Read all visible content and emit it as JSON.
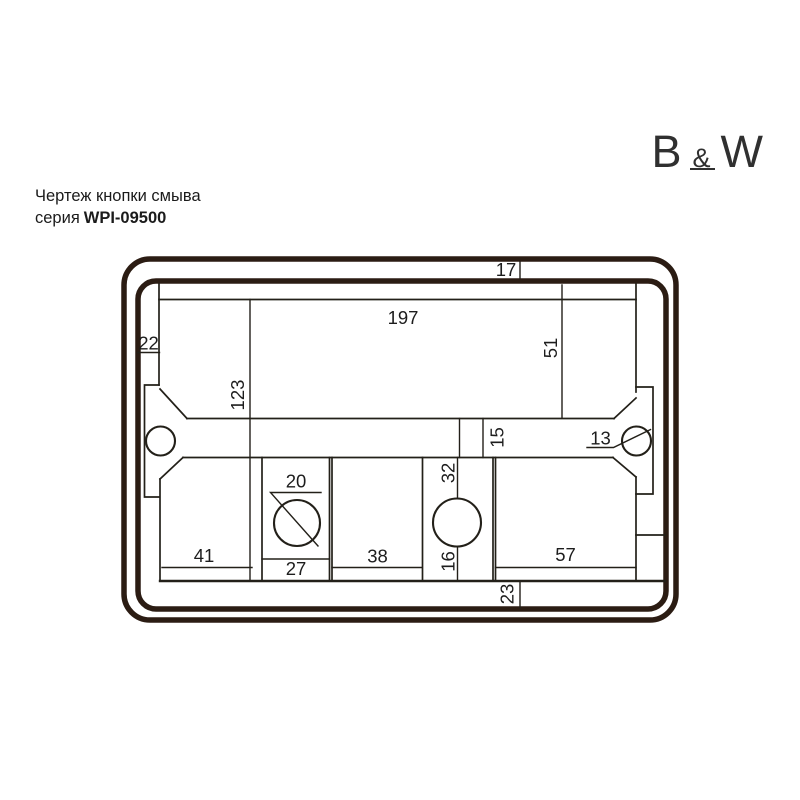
{
  "header": {
    "title": "Чертеж кнопки смыва",
    "series_label": "серия",
    "series_code": "WPI-09500"
  },
  "logo": {
    "left": "B",
    "amp": "&",
    "right": "W"
  },
  "drawing": {
    "colors": {
      "frame": "#2b1c13",
      "line": "#232019",
      "text": "#1d1d1d"
    },
    "dims": {
      "top_rim": "17",
      "plate_width": "197",
      "left_rim": "22",
      "panel_height": "51",
      "left_section_height": "123",
      "crossbar_gap": "15",
      "screw_hole": "13",
      "button_hole": "20",
      "left_panel_width": "41",
      "button_panel_width": "27",
      "mid_panel_width": "38",
      "strip_top": "32",
      "strip_bottom": "16",
      "right_panel_width": "57",
      "bottom_rim": "23"
    }
  }
}
